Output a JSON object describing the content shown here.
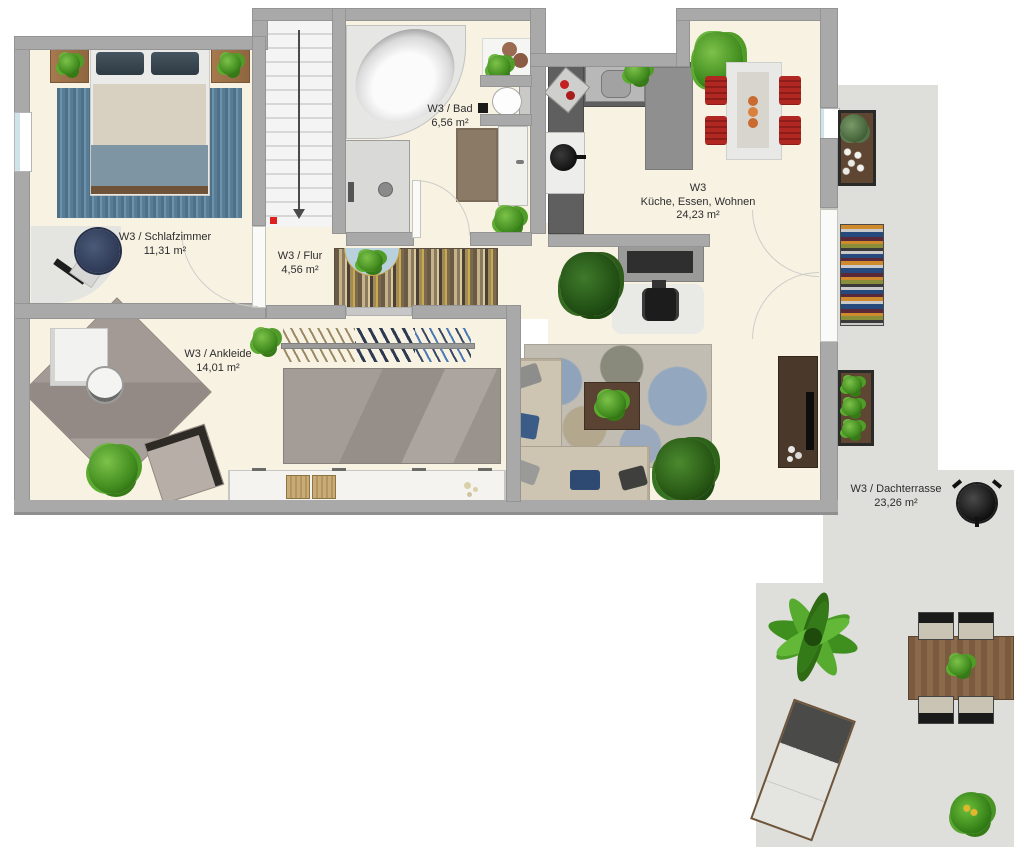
{
  "plan": {
    "unit": "W3",
    "rooms": {
      "schlafzimmer": {
        "label": "W3 / Schlafzimmer",
        "area": "11,31 m²"
      },
      "flur": {
        "label": "W3 / Flur",
        "area": "4,56 m²"
      },
      "bad": {
        "label": "W3 / Bad",
        "area": "6,56 m²"
      },
      "kueche": {
        "line1": "W3",
        "line2": "Küche, Essen, Wohnen",
        "area": "24,23 m²"
      },
      "ankleide": {
        "label": "W3 / Ankleide",
        "area": "14,01 m²"
      },
      "dachterrasse": {
        "label": "W3 / Dachterrasse",
        "area": "23,26 m²"
      }
    },
    "colors": {
      "wall": "#a9a9a9",
      "floor": "#f8f2e3",
      "terrace_floor": "#dededb",
      "dining_chair_red": "#b12721",
      "bedroom_rug_blue": "#5c8098",
      "wood": "#8a6a4a",
      "stair_arrow": "#444444",
      "entry_marker_red": "#e02020"
    },
    "furniture": {
      "schlafzimmer": [
        "double-bed",
        "nightstand",
        "nightstand",
        "striped-rug",
        "desk",
        "office-chair"
      ],
      "bad": [
        "corner-bathtub",
        "washing-machine",
        "toilet",
        "vanity-sink",
        "side-table",
        "bath-mat",
        "plant"
      ],
      "kueche": [
        "kitchen-counter",
        "sink",
        "cooktop",
        "tall-unit",
        "dining-table",
        "red-chair",
        "red-chair",
        "red-chair",
        "red-chair"
      ],
      "wohnen": [
        "corner-sofa",
        "coffee-table",
        "floral-rug",
        "tv-sideboard",
        "desk-nook",
        "office-chair",
        "plant"
      ],
      "ankleide": [
        "dressing-table",
        "stool",
        "armchair",
        "diamond-rug",
        "clothes-rack",
        "wardrobe-rug",
        "cabinet-row",
        "baskets"
      ],
      "dachterrasse": [
        "planter-box",
        "striped-outdoor-rug",
        "planter-box",
        "kettle-grill",
        "palm-plant",
        "outdoor-dining-table",
        "outdoor-chairs",
        "sun-lounger",
        "flower-pot"
      ]
    }
  }
}
